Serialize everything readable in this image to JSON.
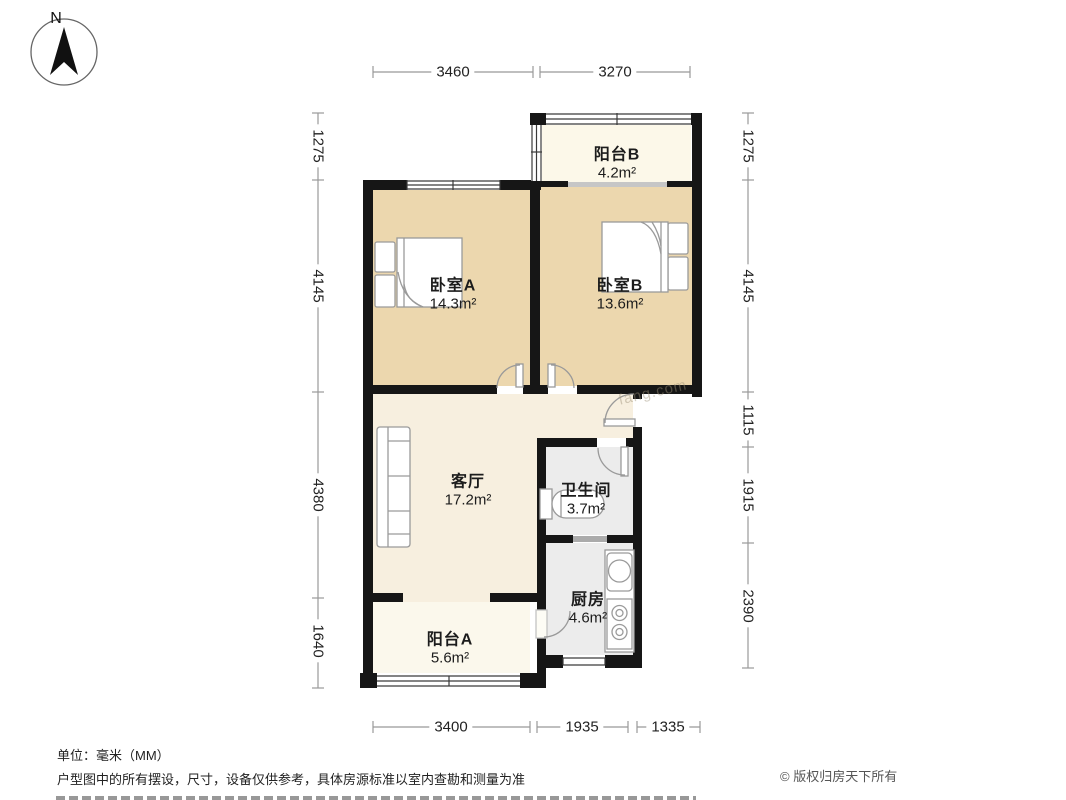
{
  "compass": {
    "label": "N"
  },
  "rooms": [
    {
      "id": "balcony-b",
      "name": "阳台B",
      "area": "4.2m²"
    },
    {
      "id": "bedroom-a",
      "name": "卧室A",
      "area": "14.3m²"
    },
    {
      "id": "bedroom-b",
      "name": "卧室B",
      "area": "13.6m²"
    },
    {
      "id": "living-room",
      "name": "客厅",
      "area": "17.2m²"
    },
    {
      "id": "bathroom",
      "name": "卫生间",
      "area": "3.7m²"
    },
    {
      "id": "kitchen",
      "name": "厨房",
      "area": "4.6m²"
    },
    {
      "id": "balcony-a",
      "name": "阳台A",
      "area": "5.6m²"
    }
  ],
  "dimensions": {
    "top": [
      "3460",
      "3270"
    ],
    "bottom": [
      "3400",
      "1935",
      "1335"
    ],
    "left": [
      "1275",
      "4145",
      "4380",
      "1640"
    ],
    "right": [
      "1275",
      "4145",
      "1115",
      "1915",
      "2390"
    ]
  },
  "footer": {
    "unit": "单位：毫米（MM）",
    "disclaimer": "户型图中的所有摆设，尺寸，设备仅供参考，具体房源标准以室内查勘和测量为准",
    "copyright": "© 版权归房天下所有"
  },
  "watermark": "fang.com",
  "colors": {
    "wall": "#161616",
    "bedroom_floor": "#ecd7ae",
    "living_floor": "#f7efdf",
    "balcony_floor": "#fbf8ec",
    "wet_floor": "#ececec",
    "dim_line": "#999999"
  }
}
